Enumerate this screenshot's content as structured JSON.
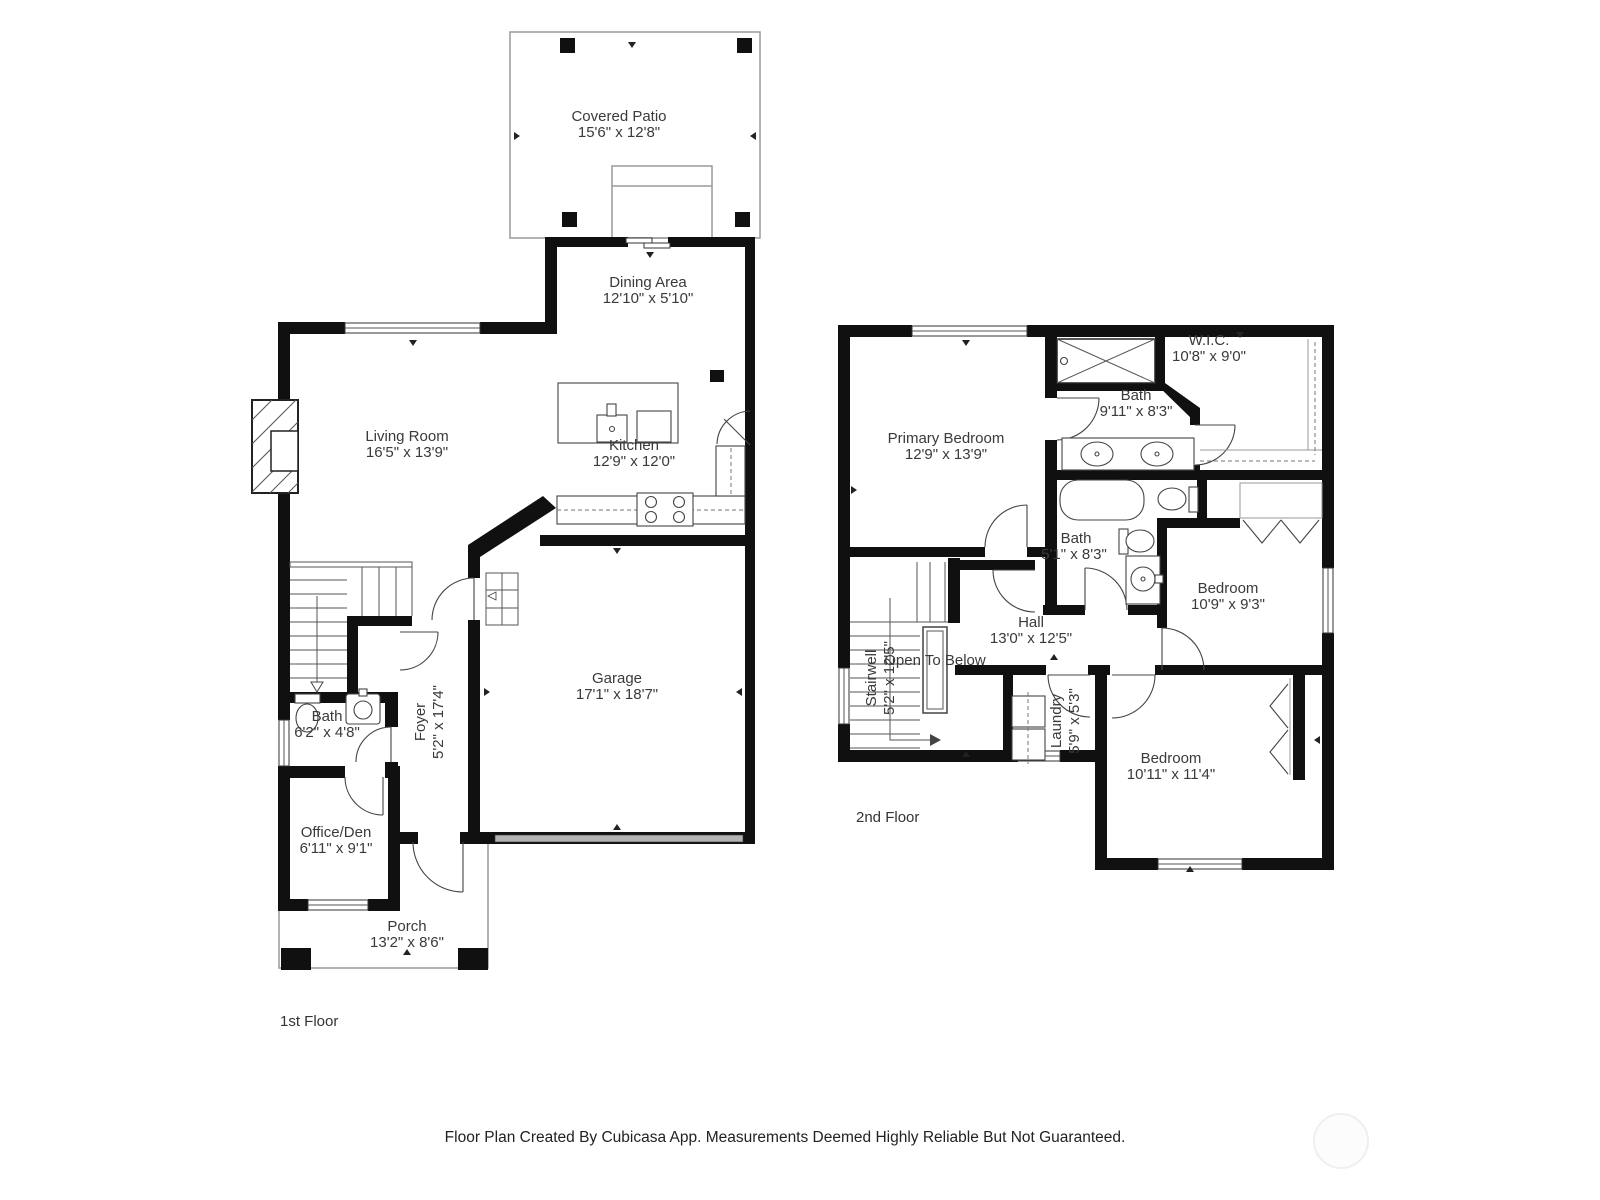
{
  "floor1": {
    "caption": "1st Floor",
    "rooms": {
      "covered_patio": {
        "name": "Covered Patio",
        "dims": "15'6\" x 12'8\""
      },
      "dining": {
        "name": "Dining Area",
        "dims": "12'10\" x 5'10\""
      },
      "living": {
        "name": "Living Room",
        "dims": "16'5\" x 13'9\""
      },
      "kitchen": {
        "name": "Kitchen",
        "dims": "12'9\" x 12'0\""
      },
      "garage": {
        "name": "Garage",
        "dims": "17'1\" x 18'7\""
      },
      "foyer": {
        "name": "Foyer",
        "dims": "5'2\" x 17'4\""
      },
      "bath": {
        "name": "Bath",
        "dims": "6'2\" x 4'8\""
      },
      "office": {
        "name": "Office/Den",
        "dims": "6'11\" x 9'1\""
      },
      "porch": {
        "name": "Porch",
        "dims": "13'2\" x 8'6\""
      }
    }
  },
  "floor2": {
    "caption": "2nd Floor",
    "rooms": {
      "primary": {
        "name": "Primary Bedroom",
        "dims": "12'9\" x 13'9\""
      },
      "wic": {
        "name": "W.I.C.",
        "dims": "10'8\" x 9'0\""
      },
      "bath_upper": {
        "name": "Bath",
        "dims": "9'11\" x 8'3\""
      },
      "bath_lower": {
        "name": "Bath",
        "dims": "5'1\" x 8'3\""
      },
      "bedroom_upper": {
        "name": "Bedroom",
        "dims": "10'9\" x 9'3\""
      },
      "hall": {
        "name": "Hall",
        "dims": "13'0\" x 12'5\""
      },
      "stairwell": {
        "name": "Stairwell",
        "dims": "5'2\" x 12'5\""
      },
      "open_below": {
        "name": "Open To Below"
      },
      "laundry": {
        "name": "Laundry",
        "dims": "5'9\" x 5'3\""
      },
      "bedroom_lower": {
        "name": "Bedroom",
        "dims": "10'11\" x 11'4\""
      }
    }
  },
  "footer": {
    "disclaimer": "Floor Plan Created By Cubicasa App. Measurements Deemed Highly Reliable But Not Guaranteed."
  }
}
